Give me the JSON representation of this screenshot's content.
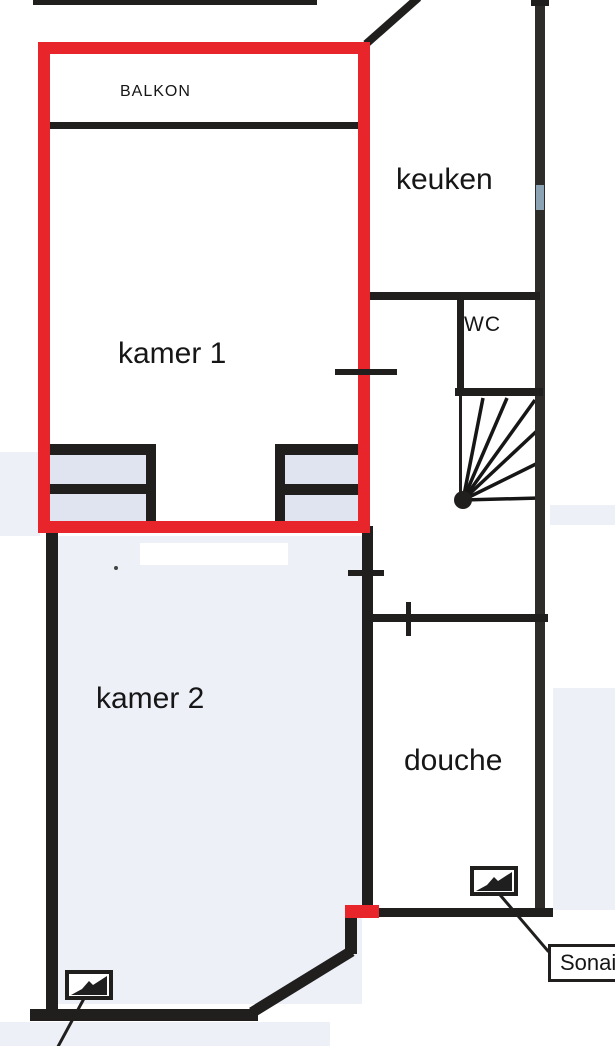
{
  "document": {
    "kind_label": "floor plan (scanned)"
  },
  "rooms": {
    "balkon": "BALKON",
    "keuken": "keuken",
    "wc": "WC",
    "kamer1": "kamer 1",
    "kamer2": "kamer 2",
    "douche": "douche"
  },
  "annotations": {
    "sonair": "Sonair"
  },
  "icons": {
    "detector": "black-wedge-in-box-detector-icon",
    "stairs": "fan-line-winder-stairs",
    "red_highlight": "red-marker-outline-around-kamer1-and-balkon"
  },
  "colors": {
    "wall": "#201f1e",
    "red": "#e8252b",
    "tint": "#edf0f7",
    "furn": "#e0e4f0",
    "text": "#161616",
    "paper": "#ffffff"
  }
}
